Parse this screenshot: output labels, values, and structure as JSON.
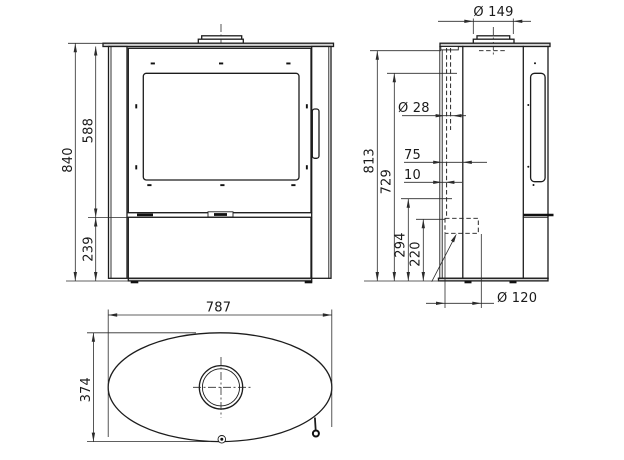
{
  "drawing": {
    "front_view": {
      "overall_height": "840",
      "body_height": "588",
      "base_height": "239"
    },
    "side_view": {
      "flue_collar_diameter": "Ø 149",
      "intake_pipe_diameter": "Ø 28",
      "intake_offset": "75",
      "intake_gap": "10",
      "flue_center_height": "813",
      "intake_top_height": "729",
      "outlet_top_height": "294",
      "outlet_center_height": "220",
      "rear_outlet_diameter": "Ø 120"
    },
    "top_view": {
      "overall_width": "787",
      "overall_depth": "374"
    }
  },
  "colors": {
    "line": "#1c1c1c",
    "dimension": "#2b2b2b",
    "panel_gray": "#d4d4d4",
    "background": "#ffffff"
  }
}
